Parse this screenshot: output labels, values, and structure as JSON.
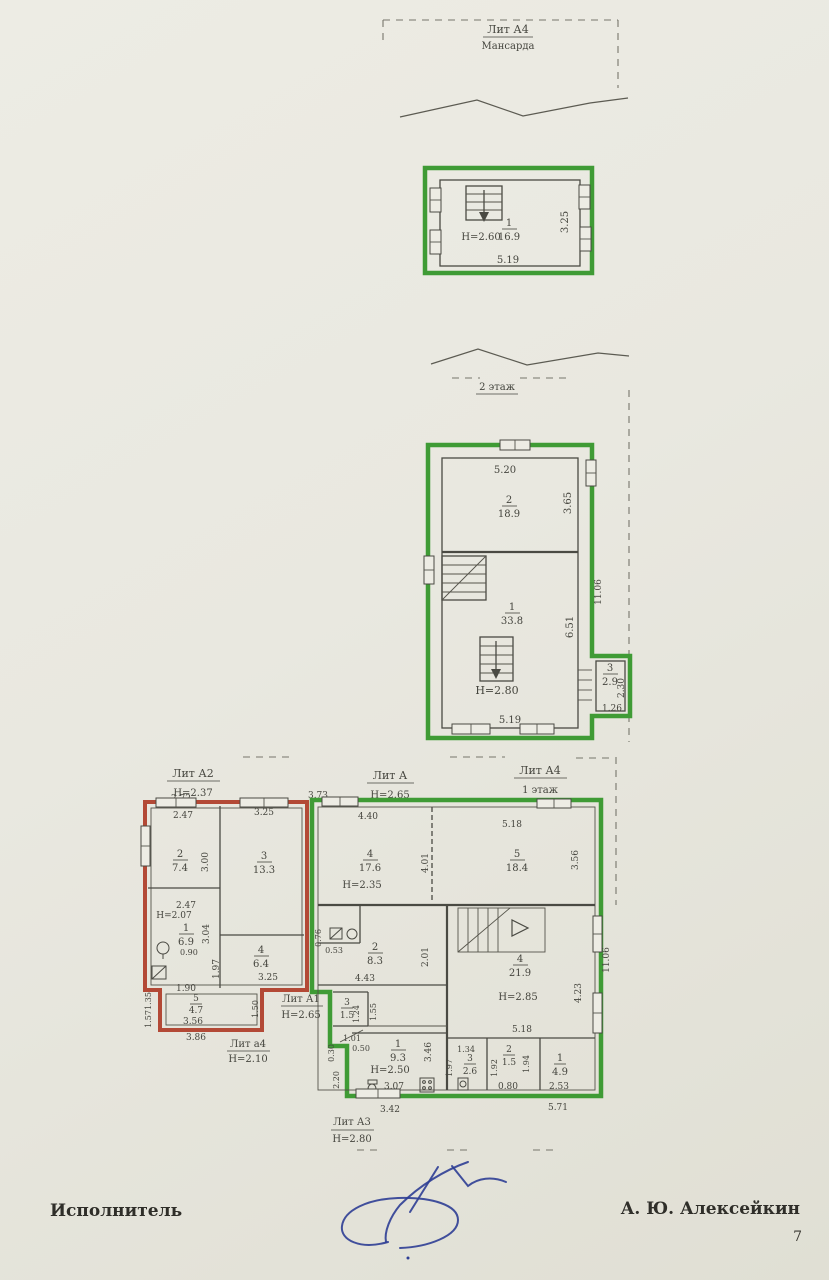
{
  "doc": {
    "executor_label": "Исполнитель",
    "executor_name": "А. Ю. Алексейкин",
    "page_number": "7"
  },
  "palette": {
    "paper": "#e9e8e0",
    "outline_green": "#3f9b35",
    "outline_red": "#b34936",
    "ink": "#45453e",
    "signature_blue": "#2e3e95"
  },
  "attic": {
    "lit": "Лит А4",
    "name": "Мансарда",
    "room": {
      "num": "1",
      "area": "16.9"
    },
    "height": "Н=2.60",
    "dim_bottom": "5.19",
    "dim_right": "3.25"
  },
  "floor2": {
    "name": "2 этаж",
    "dim_top": "5.20",
    "room2": {
      "num": "2",
      "area": "18.9"
    },
    "room1": {
      "num": "1",
      "area": "33.8"
    },
    "room3": {
      "num": "3",
      "area": "2.9"
    },
    "height": "Н=2.80",
    "dim_right_top": "3.65",
    "dim_right_mid": "6.51",
    "dim_overall_right": "11.06",
    "dim_bottom": "5.19",
    "dim_annex_right": "2.30",
    "dim_annex_bottom": "1.26"
  },
  "floor1": {
    "lit_a2": {
      "label": "Лит А2",
      "height": "Н=2.37"
    },
    "lit_a": {
      "label": "Лит А",
      "height": "Н=2.65"
    },
    "lit_a4": {
      "label": "Лит А4",
      "floor": "1 этаж"
    },
    "lit_a1": {
      "label": "Лит А1",
      "height": "Н=2.65"
    },
    "lit_a4_small": {
      "label": "Лит а4",
      "height": "Н=2.10"
    },
    "lit_a3": {
      "label": "Лит А3",
      "height": "Н=2.80"
    },
    "rooms": {
      "r74": {
        "num": "2",
        "area": "7.4"
      },
      "r133": {
        "num": "3",
        "area": "13.3"
      },
      "r69": {
        "num": "1",
        "area": "6.9",
        "height": "Н=2.07"
      },
      "r64": {
        "num": "4",
        "area": "6.4"
      },
      "r47": {
        "num": "5",
        "area": "4.7"
      },
      "r176": {
        "num": "4",
        "area": "17.6",
        "height": "Н=2.35"
      },
      "r184": {
        "num": "5",
        "area": "18.4"
      },
      "r83": {
        "num": "2",
        "area": "8.3"
      },
      "r219": {
        "num": "4",
        "area": "21.9",
        "height": "Н=2.85"
      },
      "r15a": {
        "num": "3",
        "area": "1.5"
      },
      "r93": {
        "num": "1",
        "area": "9.3",
        "height": "Н=2.50"
      },
      "r26": {
        "num": "3",
        "area": "2.6"
      },
      "r15b": {
        "num": "2",
        "area": "1.5"
      },
      "r49": {
        "num": "1",
        "area": "4.9"
      }
    },
    "dims": {
      "top_272": "2.72",
      "top_373": "3.73",
      "a2_top_247": "2.47",
      "a2_top_325": "3.25",
      "a2_left_300": "3.00",
      "a2_mid_247": "2.47",
      "a2_right_304": "3.04",
      "fixture_090": "0.90",
      "a2_197": "1.97",
      "a2_325b": "3.25",
      "a2_190": "1.90",
      "a2_135": "1.35",
      "a2_157": "1.57",
      "a2_150": "1.50",
      "a2_356": "3.56",
      "a2_386": "3.86",
      "a_440": "4.40",
      "a_401": "4.01",
      "a_518a": "5.18",
      "a_356": "3.56",
      "a_076": "0.76",
      "a_053": "0.53",
      "a_201": "2.01",
      "a_443": "4.43",
      "a_518b": "5.18",
      "a_423": "4.23",
      "overall_1106": "11.06",
      "a1_124": "1.24",
      "a1_155": "1.55",
      "a1_101": "1.01",
      "a1_050": "0.50",
      "a3_307": "3.07",
      "a3_346": "3.46",
      "a3_030": "0.30",
      "a3_220": "2.20",
      "b_134": "1.34",
      "b_197": "1.97",
      "b_192": "1.92",
      "b_194": "1.94",
      "b_080": "0.80",
      "b_253": "2.53",
      "bottom_342": "3.42",
      "bottom_571": "5.71"
    }
  }
}
